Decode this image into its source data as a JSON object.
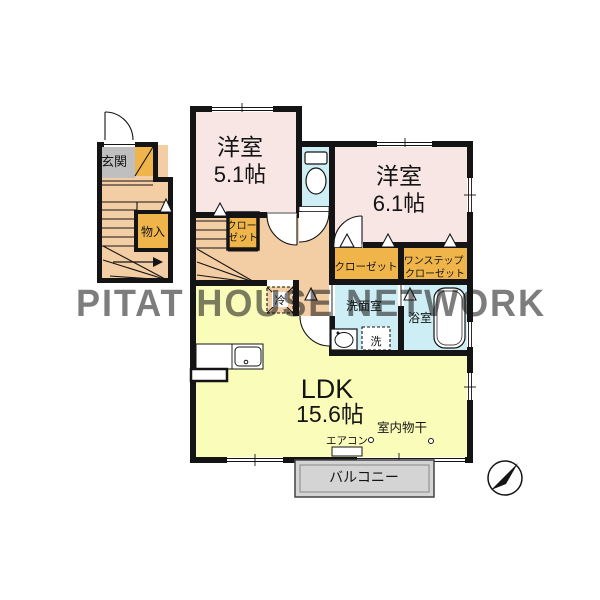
{
  "watermark": "PITAT HOUSE NETWORK",
  "rooms": {
    "western1": {
      "name": "洋室",
      "size": "5.1帖"
    },
    "western2": {
      "name": "洋室",
      "size": "6.1帖"
    },
    "ldk": {
      "name": "LDK",
      "size": "15.6帖"
    },
    "entrance": "玄関",
    "storage": "物入",
    "closet_small_line1": "クロー",
    "closet_small_line2": "ゼット",
    "closet2": "クローゼット",
    "one_step_line1": "ワンステップ",
    "one_step_line2": "クローゼット",
    "washroom": "洗面室",
    "bathroom": "浴室",
    "washer": "洗",
    "fridge": "冷",
    "aircon": "エアコン",
    "indoor_drying": "室内物干",
    "balcony": "バルコニー"
  },
  "colors": {
    "room_pink": "#f8e6e4",
    "hall_tan": "#f3cda3",
    "closet_orange": "#efb54b",
    "wet_blue": "#cdeef4",
    "ldk_yellow": "#fafcb9",
    "genkan_gray": "#bfbfbf",
    "balcony_gray": "#d4d4d4",
    "wall_black": "#141414",
    "watermark_gray": "#c9c9c3"
  }
}
